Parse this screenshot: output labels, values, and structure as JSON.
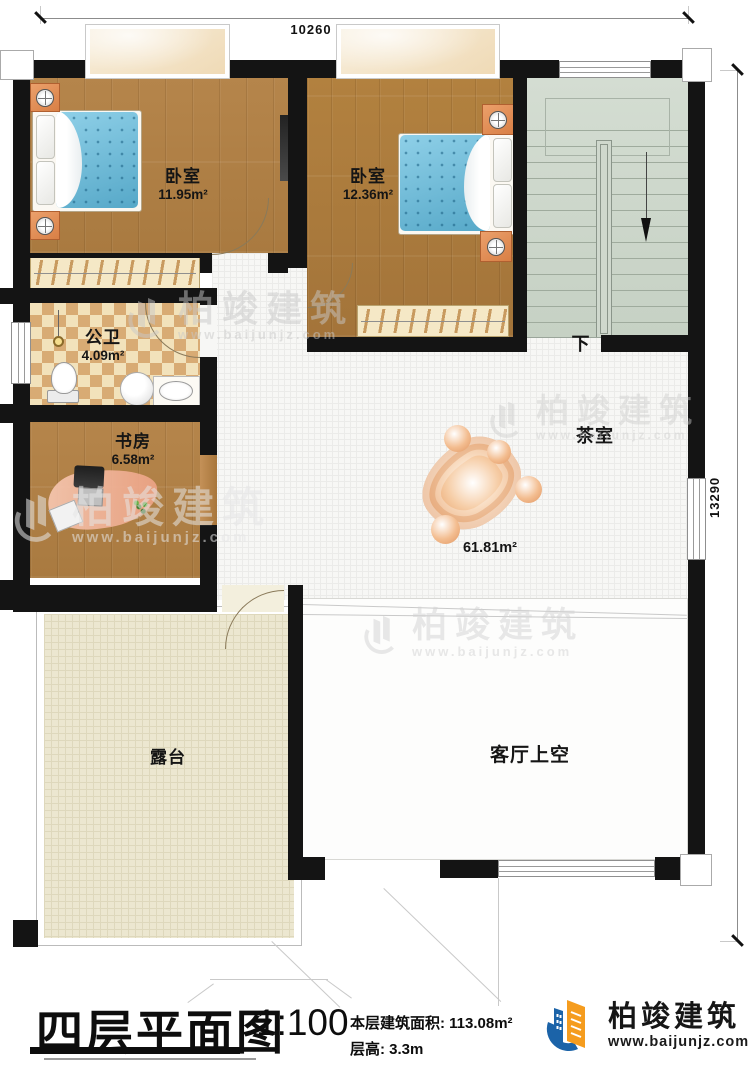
{
  "titleblock": {
    "sheet_title": "四层平面图",
    "scale": "1:100",
    "floor_area_label": "本层建筑面积:",
    "floor_area_value": "113.08m²",
    "floor_height_label": "层高:",
    "floor_height_value": "3.3m"
  },
  "brand": {
    "name": "柏竣建筑",
    "website": "www.baijunjz.com"
  },
  "watermark": {
    "name": "柏竣建筑",
    "website": "www.baijunjz.com"
  },
  "dimensions": {
    "top_width": "10260",
    "right_height": "13290"
  },
  "stairs": {
    "down_label": "下"
  },
  "rooms": [
    {
      "id": "bedroom-left",
      "name": "卧室",
      "area": "11.95m²"
    },
    {
      "id": "bedroom-right",
      "name": "卧室",
      "area": "12.36m²"
    },
    {
      "id": "bathroom",
      "name": "公卫",
      "area": "4.09m²"
    },
    {
      "id": "study",
      "name": "书房",
      "area": "6.58m²"
    },
    {
      "id": "tearoom",
      "name": "茶室",
      "area": "61.81m²"
    },
    {
      "id": "terrace",
      "name": "露台",
      "area": ""
    },
    {
      "id": "living-void",
      "name": "客厅上空",
      "area": ""
    }
  ],
  "colors": {
    "wall": "#141414",
    "wood_floor": "#b0824a",
    "tile_floor": "#f7f7f5",
    "terrace_floor": "#ece7d0",
    "bath_checker": "#d8ab74",
    "stair_floor": "#cdd7cb",
    "bed_blue": "#6fc0dc",
    "nightstand_orange": "#e08b52",
    "sofa_blob_orange": "#e39a63",
    "logo_blue": "#1b63a8",
    "logo_orange": "#f59c1e"
  }
}
